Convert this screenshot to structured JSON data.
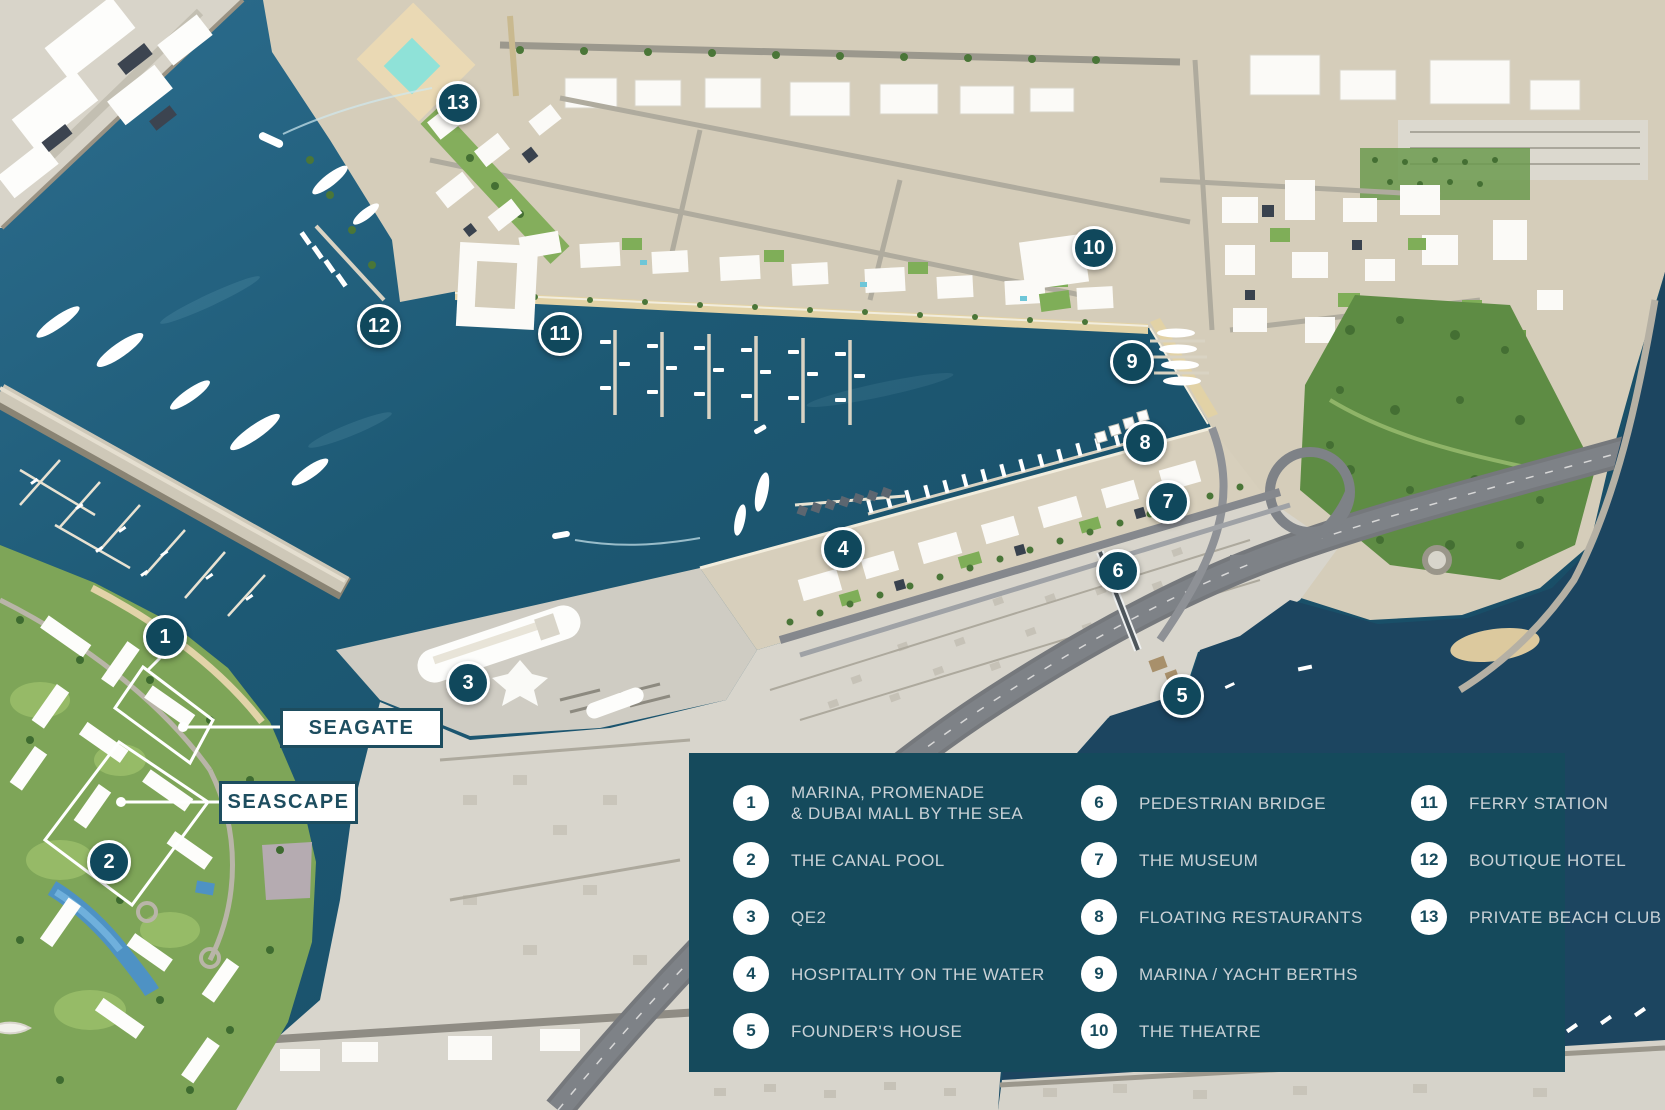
{
  "map": {
    "markers": [
      {
        "num": "1"
      },
      {
        "num": "2"
      },
      {
        "num": "3"
      },
      {
        "num": "4"
      },
      {
        "num": "5"
      },
      {
        "num": "6"
      },
      {
        "num": "7"
      },
      {
        "num": "8"
      },
      {
        "num": "9"
      },
      {
        "num": "10"
      },
      {
        "num": "11"
      },
      {
        "num": "12"
      },
      {
        "num": "13"
      }
    ],
    "labels": {
      "seagate": "SEAGATE",
      "seascape": "SEASCAPE"
    }
  },
  "legend": {
    "items": [
      {
        "num": "1",
        "line1": "MARINA, PROMENADE",
        "line2": "& DUBAI MALL BY THE SEA"
      },
      {
        "num": "2",
        "line1": "THE CANAL POOL",
        "line2": ""
      },
      {
        "num": "3",
        "line1": "QE2",
        "line2": ""
      },
      {
        "num": "4",
        "line1": "HOSPITALITY ON THE WATER",
        "line2": ""
      },
      {
        "num": "5",
        "line1": "FOUNDER'S HOUSE",
        "line2": ""
      },
      {
        "num": "6",
        "line1": "PEDESTRIAN BRIDGE",
        "line2": ""
      },
      {
        "num": "7",
        "line1": "THE MUSEUM",
        "line2": ""
      },
      {
        "num": "8",
        "line1": "FLOATING RESTAURANTS",
        "line2": ""
      },
      {
        "num": "9",
        "line1": "MARINA / YACHT BERTHS",
        "line2": ""
      },
      {
        "num": "10",
        "line1": "THE THEATRE",
        "line2": ""
      },
      {
        "num": "11",
        "line1": "FERRY STATION",
        "line2": ""
      },
      {
        "num": "12",
        "line1": "BOUTIQUE HOTEL",
        "line2": ""
      },
      {
        "num": "13",
        "line1": "PRIVATE BEACH CLUB",
        "line2": ""
      }
    ]
  },
  "colors": {
    "panel": "#154a5c",
    "marker": "#10485c",
    "tag_text": "#1d4d5f",
    "water": "#1d5974"
  }
}
